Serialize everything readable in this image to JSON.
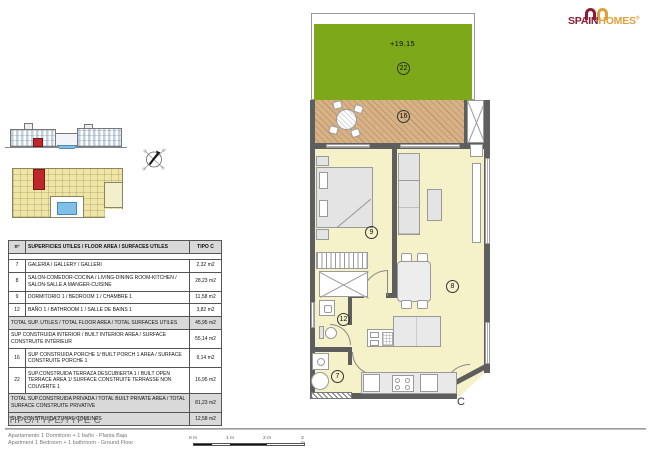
{
  "logo": {
    "brand_primary": "SPAIN",
    "brand_secondary": "HOMES",
    "registered": "®"
  },
  "plan": {
    "terrace_level": "+19.15",
    "room_numbers": {
      "terrace": "22",
      "porch": "16",
      "bedroom": "9",
      "living": "8",
      "bathroom": "12",
      "gallery": "7"
    },
    "block_letter": "C"
  },
  "table": {
    "header": {
      "num": "nº",
      "desc": "SUPERFICIES UTILES / FLOOR AREA / SURFACES UTILES",
      "type": "TIPO C"
    },
    "rows": [
      {
        "num": "7",
        "desc": "GALERÍA / GALLERY / GALLERI",
        "value": "2,32 m2"
      },
      {
        "num": "8",
        "desc": "SALON-COMEDOR-COCINA / LIVING-DINING ROOM-KITCHEN / SALON-SALLE A MANGER-CUISINE",
        "value": "28,23 m2"
      },
      {
        "num": "9",
        "desc": "DORMITORIO 1 / BEDROOM 1 / CHAMBRE 1",
        "value": "11,58 m2"
      },
      {
        "num": "12",
        "desc": "BAÑO 1 / BATHROOM 1 / SALLE DE BAINS 1",
        "value": "3,82 m2"
      },
      {
        "num": "",
        "desc": "TOTAL SUP. UTILES / TOTAL FLOOR AREA / TOTAL SURFACES UTILES",
        "value": "45,95 m2"
      },
      {
        "num": "",
        "desc": "SUP CONSTRUIDA INTERIOR / BUILT INTERIOR AREA / SURFACE CONSTRUITE INTÉRIEUR",
        "value": "55,14 m2"
      },
      {
        "num": "16",
        "desc": "SUP CONSTRUIDA PORCHE 1/ BUILT PORCH 1 AREA / SURFACE CONSTRUITE PORCHE 1",
        "value": "9,14 m2"
      },
      {
        "num": "22",
        "desc": "SUP.CONSTRUIDA TERRAZA DESCUBIERTA 1 / BUILT OPEN TERRACE AREA 1/ SURFACE CONSTRUITE TERRASSE NON COUVERTE 1",
        "value": "16,95 m2"
      },
      {
        "num": "",
        "desc": "TOTAL SUP.CONSTRUIDA PRIVADA / TOTAL BUILT PRIVATE AREA / TOTAL SURFACE CONSTRUITE PRIVATIVE",
        "value": "81,23 m2"
      },
      {
        "num": "",
        "desc": "SUP. CONSTRUIDA ZONAS COMUNES",
        "value": "12,58 m2"
      }
    ]
  },
  "footer": {
    "type_title": "TIPO/TYPE/TYPE C",
    "description_es": "Apartamento 1 Dormitorio + 1 baño - Planta Baja",
    "description_en": "Apartment 1 Bedroom + 1 bathroom - Ground Floor",
    "scale_labels": [
      "0 m",
      "1 m",
      "2 m",
      "3 m"
    ]
  },
  "colors": {
    "terrace_green": "#7CA81A",
    "porch_tan": "#D7B286",
    "floor_yellow": "#F5F2C9",
    "wall_gray": "#5E5E5E",
    "table_gray": "#D9D9D9",
    "brand_red": "#8E1D33",
    "brand_orange": "#DFA13B",
    "highlight_red": "#C0272D",
    "pool_blue": "#7FC0E8",
    "siteplan_yellow": "#EFE6A6"
  }
}
